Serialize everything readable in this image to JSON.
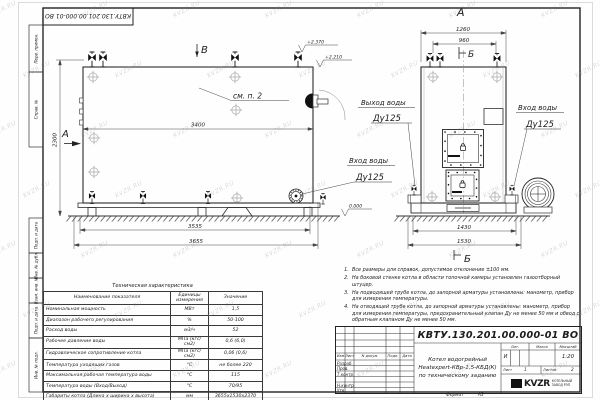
{
  "doc": {
    "number_top": "КВТУ.130.201.00.000-01 ВО"
  },
  "watermark": "KVZR.RU",
  "margin_labels": [
    "Перв. примен.",
    "Справ. №",
    "Подп. и дата",
    "Инв. № дубл.",
    "Взам. инв. №",
    "Подп. и дата",
    "Инв. № подл."
  ],
  "views": {
    "side": {
      "view_mark_top": "В",
      "view_mark_left": "А",
      "detail_ref": "см. п. 2",
      "dims": {
        "width_top": "3400",
        "height": "2300",
        "base": "3535",
        "overall": "3655"
      },
      "elevations": {
        "valve_top": "+2.370",
        "boiler_top": "+2.210",
        "ground": "0.000"
      },
      "inlet": {
        "line1": "Вход воды",
        "line2": "Ду125"
      }
    },
    "front": {
      "title": "А",
      "section_mark_top": "Б",
      "section_mark_bottom": "Б",
      "dims": {
        "width_top": "1260",
        "width_inner": "960",
        "base": "1430",
        "overall": "1530"
      },
      "outlet": {
        "line1": "Выход воды",
        "line2": "Ду125"
      },
      "inlet": {
        "line1": "Вход воды",
        "line2": "Ду125"
      }
    }
  },
  "tech_table": {
    "title": "Техническая характеристика",
    "headers": [
      "Наименование показателя",
      "Единицы измерения",
      "Значение"
    ],
    "rows": [
      [
        "Номинальная мощность",
        "МВт",
        "1,5"
      ],
      [
        "Диапазон рабочего регулирования",
        "%",
        "50-100"
      ],
      [
        "Расход воды",
        "м3/ч",
        "52"
      ],
      [
        "Рабочее давление воды",
        "МПа (кгс/см2)",
        "0,6 (6,0)"
      ],
      [
        "Гидравлическое сопротивление котла",
        "МПа (кгс/см2)",
        "0,06 (0,6)"
      ],
      [
        "Температура уходящих газов",
        "°С",
        "не более 220"
      ],
      [
        "Максимальная рабочая температура воды",
        "°С",
        "115"
      ],
      [
        "Температура воды (Вход/Выход)",
        "°С",
        "70/95"
      ],
      [
        "Габариты котла (Длина х ширина х высота)",
        "мм",
        "3655х1530х2370"
      ]
    ]
  },
  "notes": {
    "items": [
      {
        "num": "1.",
        "text": "Все размеры для справок, допустимое отклонение ±100 мм."
      },
      {
        "num": "2.",
        "text": "На боковой стенке котла в области топочной камеры установлен газоотборный штуцер."
      },
      {
        "num": "3.",
        "text": "На подводящей трубе котла, до запорной арматуры установлены: манометр, прибор для измерения температуры."
      },
      {
        "num": "4.",
        "text": "На отводящей трубе котла, до запорной арматуры установлены: манометр, прибор для измерения температуры, предохранительный клапан Ду не менее 50 мм и обвод с обратным клапаном Ду не менее 50 мм."
      }
    ]
  },
  "title_block": {
    "number": "КВТУ.130.201.00.000-01 ВО",
    "name_line1": "Котел водогрейный",
    "name_line2": "Heatexpert-КВр-1,5-КБД(К)",
    "name_line3": "по техническому заданию",
    "cols": {
      "izm": "Изм",
      "list": "Лист",
      "ndok": "N докум.",
      "podp": "Подп.",
      "data": "Дата"
    },
    "rows": {
      "razrab": "Разраб.",
      "prov": "Пров.",
      "tkontr": "Т.контр.",
      "nkontr": "Н.контр.",
      "utv": "Утв."
    },
    "lit_header": "Лит.",
    "mass_header": "Масса",
    "scale_header": "Масштаб",
    "lit_value": "И",
    "scale_value": "1:20",
    "sheet_label": "Лист",
    "sheet_value": "1",
    "sheets_label": "Листов",
    "sheets_value": "2",
    "logo_text": "KVZR",
    "company_line1": "КОТЕЛЬНЫЙ",
    "company_line2": "ЗАВОД РЭП",
    "format_label": "Формат",
    "format_value": "А3"
  }
}
